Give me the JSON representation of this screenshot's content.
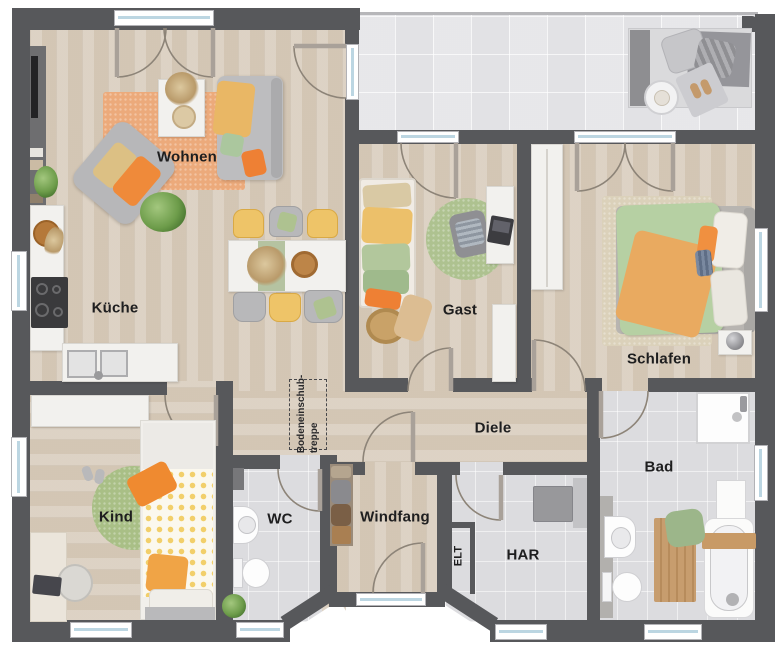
{
  "title": "Grundriss floor plan",
  "rooms": {
    "wohnen": {
      "label": "Wohnen"
    },
    "kueche": {
      "label": "Küche"
    },
    "gast": {
      "label": "Gast"
    },
    "schlafen": {
      "label": "Schlafen"
    },
    "diele": {
      "label": "Diele"
    },
    "bad": {
      "label": "Bad"
    },
    "kind": {
      "label": "Kind"
    },
    "wc": {
      "label": "WC"
    },
    "windfang": {
      "label": "Windfang"
    },
    "har": {
      "label": "HAR"
    },
    "elt": {
      "label": "ELT"
    },
    "bodentreppe": {
      "line1": "Bodeneinschub-",
      "line2": "treppe"
    }
  },
  "colors": {
    "wall": "#57585b",
    "wood": "#d8ccbc",
    "tile": "#dcdcdf",
    "terrace": "#ebebee",
    "glass": "#bcd6e2",
    "label": "#1e1e1f",
    "furn": "#f2f1ee",
    "orange": "#ee8034",
    "yellow": "#eec468",
    "green": "#aec290",
    "rug_orange": "#ecaa7b"
  }
}
